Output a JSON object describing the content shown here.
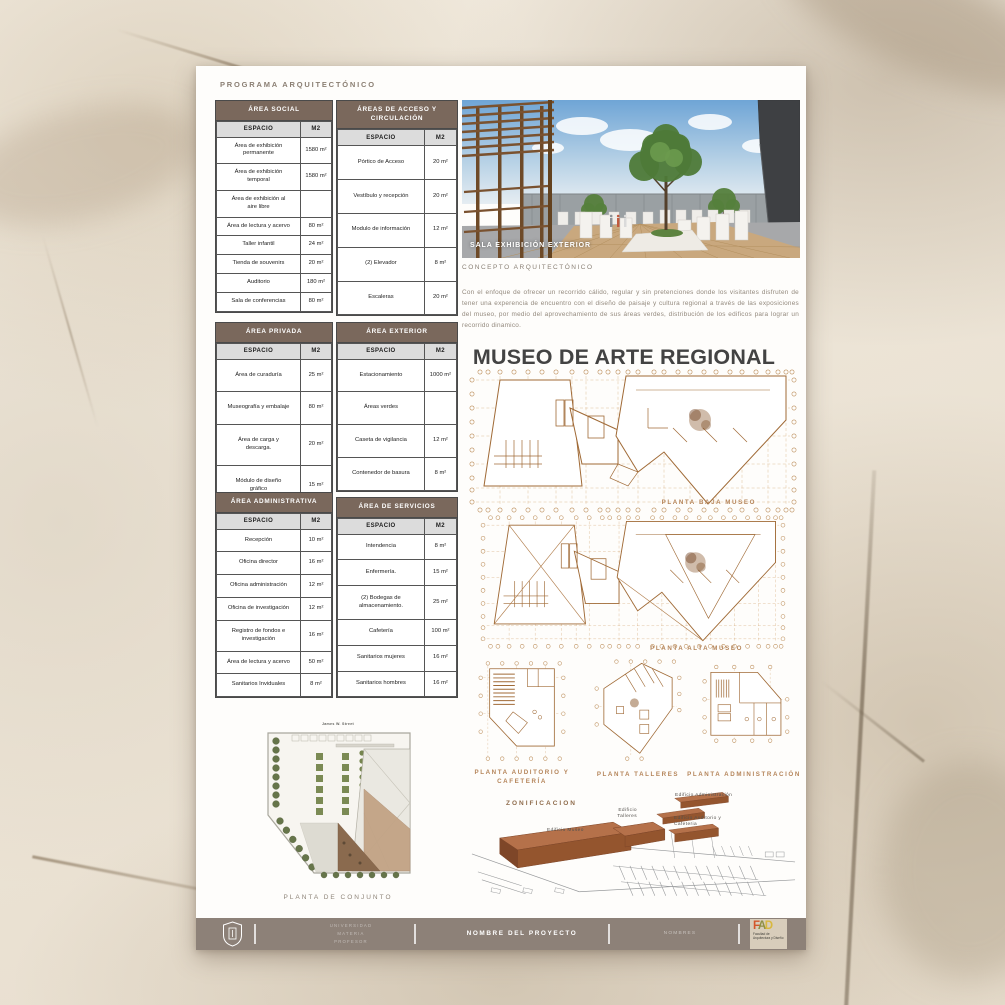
{
  "colors": {
    "table_header_bg": "#7a685c",
    "table_subheader_bg": "#dcdcdc",
    "plan_line_tan": "#b07c4a",
    "footer_bg": "#8d8178",
    "fad_f_color": "#d4562b",
    "fad_a_color": "#8f9044",
    "fad_d_color": "#d8b83e"
  },
  "heading": "PROGRAMA ARQUITECTÓNICO",
  "tables": [
    {
      "title": "ÁREA SOCIAL",
      "columns": [
        "ESPACIO",
        "M2"
      ],
      "rows": [
        [
          "Área de exhibición permanente",
          "1580 m²"
        ],
        [
          "Área de exhibición temporal",
          "1580 m²"
        ],
        [
          "Área de exhibición al aire libre",
          ""
        ],
        [
          "Área de lectura y acervo",
          "80 m²"
        ],
        [
          "Taller infantil",
          "24 m²"
        ],
        [
          "Tienda de souvenirs",
          "20 m²"
        ],
        [
          "Auditorio",
          "180 m²"
        ],
        [
          "Sala de conferencias",
          "80 m²"
        ]
      ]
    },
    {
      "title": "ÁREAS DE ACCESO Y CIRCULACIÓN",
      "columns": [
        "ESPACIO",
        "M2"
      ],
      "rows": [
        [
          "Pórtico de Acceso",
          "20 m²"
        ],
        [
          "Vestíbulo y recepción",
          "20 m²"
        ],
        [
          "Modulo de información",
          "12 m²"
        ],
        [
          "(2) Elevador",
          "8 m²"
        ],
        [
          "Escaleras",
          "20 m²"
        ]
      ]
    },
    {
      "title": "ÁREA PRIVADA",
      "columns": [
        "ESPACIO",
        "M2"
      ],
      "rows": [
        [
          "Área de curaduría",
          "25 m²"
        ],
        [
          "Museografía y embalaje",
          "80 m²"
        ],
        [
          "Área de carga y descarga.",
          "20 m²"
        ],
        [
          "Módulo de diseño gráfico",
          "15 m²"
        ]
      ]
    },
    {
      "title": "ÁREA EXTERIOR",
      "columns": [
        "ESPACIO",
        "M2"
      ],
      "rows": [
        [
          "Estacionamiento",
          "1000 m²"
        ],
        [
          "Áreas verdes",
          ""
        ],
        [
          "Caseta de vigilancia",
          "12 m²"
        ],
        [
          "Contenedor de basura",
          "8 m²"
        ]
      ]
    },
    {
      "title": "ÁREA ADMINISTRATIVA",
      "columns": [
        "ESPACIO",
        "M2"
      ],
      "rows": [
        [
          "Recepción",
          "10 m²"
        ],
        [
          "Oficina director",
          "16 m²"
        ],
        [
          "Oficina administración",
          "12 m²"
        ],
        [
          "Oficina de investigación",
          "12 m²"
        ],
        [
          "Registro de fondos e investigación",
          "16 m²"
        ],
        [
          "Área de lectura y acervo",
          "50 m²"
        ],
        [
          "Sanitarios Inviduales",
          "8 m²"
        ]
      ]
    },
    {
      "title": "ÁREA DE SERVICIOS",
      "columns": [
        "ESPACIO",
        "M2"
      ],
      "rows": [
        [
          "Intendencia",
          "8 m²"
        ],
        [
          "Enfermería.",
          "15 m²"
        ],
        [
          "(2) Bodegas de almacenamiento.",
          "25 m²"
        ],
        [
          "Cafetería",
          "100 m²"
        ],
        [
          "Sanitarios mujeres",
          "16 m²"
        ],
        [
          "Sanitarios hombres",
          "16 m²"
        ]
      ]
    }
  ],
  "render": {
    "caption": "SALA EXHIBICIÓN EXTERIOR"
  },
  "concepto": {
    "heading": "CONCEPTO ARQUITECTÓNICO",
    "body": "Con el enfoque de ofrecer un recorrido cálido, regular y sin pretenciones donde los visitantes disfruten de tener una experencia de encuentro con el diseño de paisaje y cultura regional a través de las exposiciones del museo, por medio del aprovechamiento de sus áreas verdes, distribución de los edificos para lograr un recorrido dinamico."
  },
  "museo": {
    "title": "MUSEO DE ARTE REGIONAL",
    "plan_labels": {
      "baja": "PLANTA BAJA MUSEO",
      "alta": "PLANTA ALTA MUSEO",
      "auditorio": "PLANTA AUDITORIO Y CAFETERÍA",
      "talleres": "PLANTA TALLERES",
      "administracion": "PLANTA ADMINISTRACIÓN"
    }
  },
  "zonificacion": {
    "label": "ZONIFICACION",
    "edificio_museo": "Edificio Museo",
    "edificio_talleres": "Edificio Talleres",
    "edificio_administracion": "Edificio Administración",
    "edificio_auditorio": "Edificio Auditorio y Cafeteria"
  },
  "conjunto": {
    "label": "PLANTA DE CONJUNTO",
    "street": "James W. Street"
  },
  "footer": {
    "university_lines": [
      "UNIVERSIDAD",
      "MATERIA",
      "PROFESOR"
    ],
    "project": "NOMBRE DEL PROYECTO",
    "names": "NOMBRES",
    "fad": {
      "letters": [
        "F",
        "A",
        "D"
      ],
      "caption": "Facultad de Arquitectura y Diseño"
    }
  }
}
